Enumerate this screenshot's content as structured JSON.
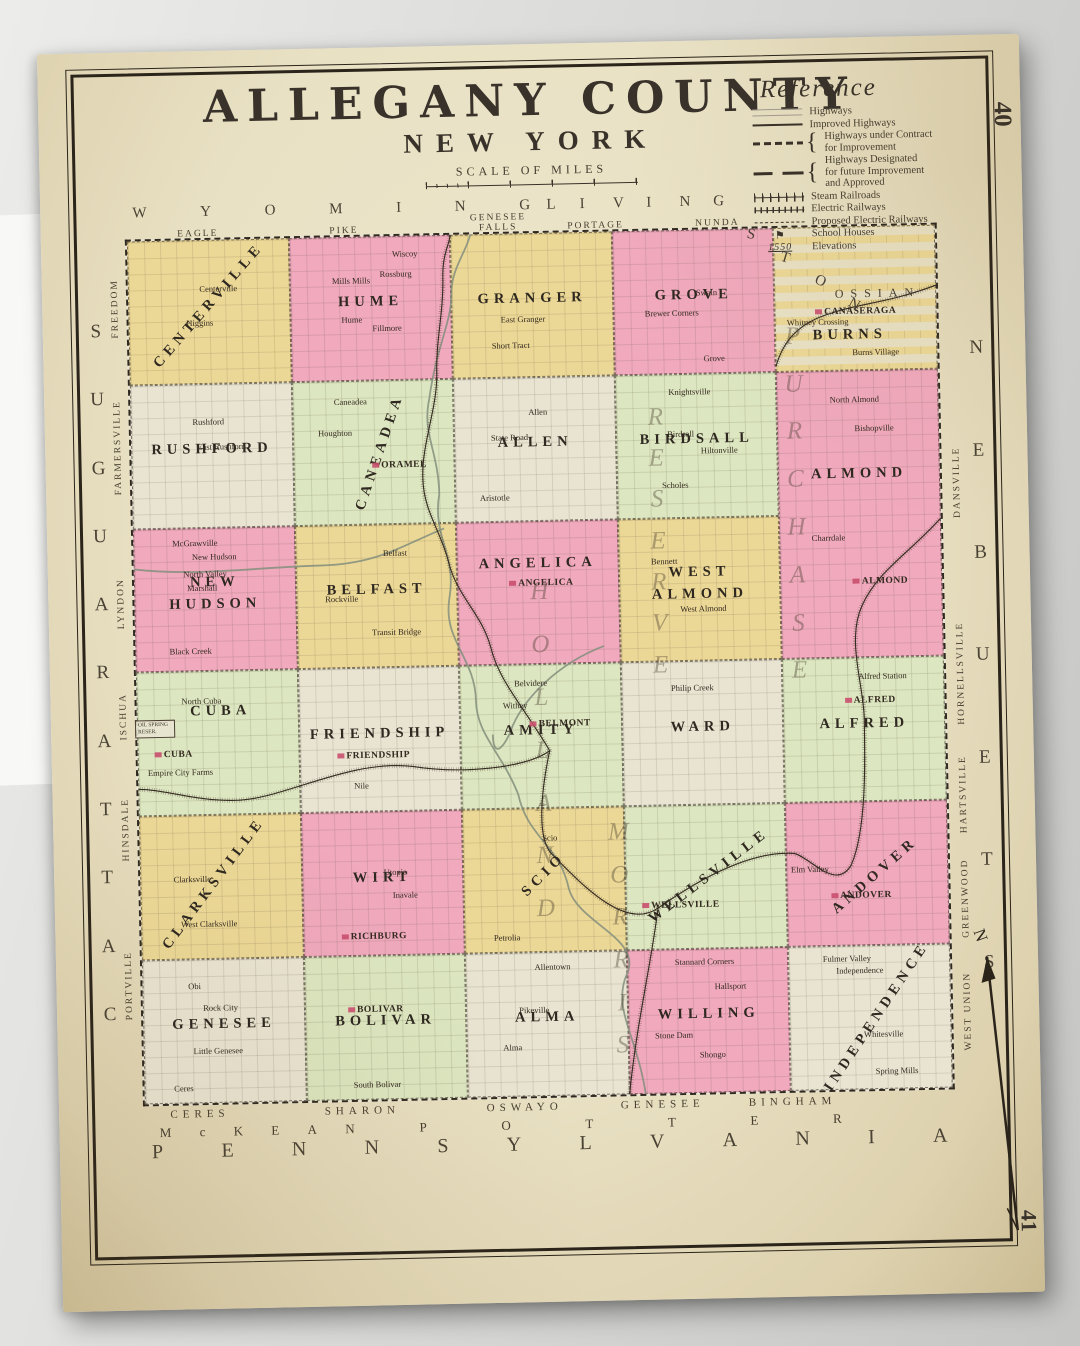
{
  "page": {
    "top_right_number": "40",
    "bottom_right_number": "41"
  },
  "title": {
    "county": "ALLEGANY COUNTY",
    "state": "NEW YORK",
    "scale_label": "SCALE OF MILES"
  },
  "compass": {
    "north_label": "N"
  },
  "colors": {
    "paper": "#e9e1c4",
    "yellow": "#ecd896",
    "pink": "#f0a9bd",
    "green": "#dce6c0",
    "cream": "#e9e4d2",
    "line": "#2f2820",
    "village_red": "#c94f6e"
  },
  "reference": {
    "title": "Reference",
    "items": [
      {
        "label": "Highways",
        "sample": "highways"
      },
      {
        "label": "Improved Highways",
        "sample": "improved"
      },
      {
        "label": "Highways under Contract\nfor Improvement",
        "sample": "contract",
        "brace": true
      },
      {
        "label": "Highways Designated\nfor future Improvement\nand Approved",
        "sample": "future",
        "brace": true
      },
      {
        "label": "Steam Railroads",
        "sample": "steam"
      },
      {
        "label": "Electric Railways",
        "sample": "electric"
      },
      {
        "label": "Proposed Electric Railways",
        "sample": "proposed"
      },
      {
        "label": "School Houses",
        "sample": "school"
      },
      {
        "label": "Elevations",
        "sample": "elevation",
        "sample_text": "1550"
      }
    ]
  },
  "neighbors": {
    "top": {
      "counties": [
        "WYOMING",
        "LIVINGSTON"
      ],
      "townships": [
        "EAGLE",
        "PIKE",
        "GENESEE FALLS",
        "PORTAGE",
        "NUNDA",
        "OSSIAN"
      ]
    },
    "left": {
      "county": "CATTARAUGUS",
      "townships": [
        "FREEDOM",
        "FARMERSVILLE",
        "LYNDON",
        "ISCHUA",
        "HINSDALE",
        "PORTVILLE"
      ]
    },
    "right": {
      "county": "STEUBEN",
      "townships": [
        "DANSVILLE",
        "HORNELLSVILLE",
        "HARTSVILLE",
        "GREENWOOD",
        "WEST UNION"
      ]
    },
    "bottom": {
      "state": "PENNSYLVANIA",
      "counties": [
        "McKEAN",
        "POTTER"
      ],
      "townships": [
        "CERES",
        "SHARON",
        "OSWAYO",
        "GENESEE",
        "BINGHAM"
      ]
    }
  },
  "land_grants": [
    {
      "name": "HOLLAND PURCHASE"
    },
    {
      "name": "MORRIS RESERVE"
    }
  ],
  "oil_spring_label": "OIL SPRING RESER.",
  "townships": [
    {
      "name": "CENTERVILLE",
      "color": "yellow",
      "col": 1,
      "row": 1,
      "angle": -48,
      "villages": [
        {
          "n": "Centerville",
          "pos": [
            56,
            34
          ]
        },
        {
          "n": "Higgins",
          "pos": [
            44,
            58
          ]
        }
      ]
    },
    {
      "name": "HUME",
      "color": "pink",
      "col": 2,
      "row": 1,
      "villages": [
        {
          "n": "Wiscoy",
          "pos": [
            72,
            12
          ]
        },
        {
          "n": "Rossburg",
          "pos": [
            66,
            26
          ]
        },
        {
          "n": "Mills Mills",
          "pos": [
            38,
            30
          ]
        },
        {
          "n": "Hume",
          "pos": [
            38,
            58
          ]
        },
        {
          "n": "Fillmore",
          "pos": [
            60,
            64
          ]
        }
      ]
    },
    {
      "name": "GRANGER",
      "color": "yellow",
      "col": 3,
      "row": 1,
      "villages": [
        {
          "n": "East Granger",
          "pos": [
            44,
            60
          ]
        },
        {
          "n": "Short Tract",
          "pos": [
            36,
            78
          ]
        }
      ]
    },
    {
      "name": "GROVE",
      "color": "pink",
      "col": 4,
      "row": 1,
      "villages": [
        {
          "n": "Swain",
          "pos": [
            58,
            44
          ]
        },
        {
          "n": "Brewer Corners",
          "pos": [
            36,
            58
          ]
        },
        {
          "n": "Grove",
          "pos": [
            62,
            90
          ]
        }
      ]
    },
    {
      "name": "BURNS",
      "color": "yellow",
      "col": 5,
      "row": 1,
      "inset_top": true,
      "name_pos": [
        46,
        76
      ],
      "villages": [
        {
          "n": "Canaseraga",
          "major": true,
          "pos": [
            50,
            60
          ]
        },
        {
          "n": "Whitney Crossing",
          "pos": [
            26,
            66
          ]
        },
        {
          "n": "Burns Village",
          "pos": [
            62,
            88
          ]
        }
      ]
    },
    {
      "name": "RUSHFORD",
      "color": "cream",
      "col": 1,
      "row": 2,
      "villages": [
        {
          "n": "Rushford",
          "pos": [
            48,
            26
          ]
        },
        {
          "n": "East Rushford",
          "pos": [
            56,
            44
          ]
        }
      ]
    },
    {
      "name": "CANEADEA",
      "color": "green",
      "col": 2,
      "row": 2,
      "angle": -70,
      "name_pos": [
        54,
        50
      ],
      "villages": [
        {
          "n": "Caneadea",
          "pos": [
            36,
            14
          ]
        },
        {
          "n": "Houghton",
          "pos": [
            26,
            36
          ]
        },
        {
          "n": "Oramel",
          "major": true,
          "pos": [
            66,
            60
          ]
        }
      ]
    },
    {
      "name": "ALLEN",
      "color": "cream",
      "col": 3,
      "row": 2,
      "villages": [
        {
          "n": "Allen",
          "pos": [
            52,
            24
          ]
        },
        {
          "n": "State Road",
          "pos": [
            34,
            42
          ]
        },
        {
          "n": "Aristotle",
          "pos": [
            24,
            84
          ]
        }
      ]
    },
    {
      "name": "BIRDSALL",
      "color": "green",
      "col": 4,
      "row": 2,
      "villages": [
        {
          "n": "Knightsville",
          "pos": [
            46,
            12
          ]
        },
        {
          "n": "Birdsall",
          "pos": [
            40,
            42
          ]
        },
        {
          "n": "Hiltonville",
          "pos": [
            64,
            54
          ]
        },
        {
          "n": "Scholes",
          "pos": [
            36,
            78
          ]
        }
      ]
    },
    {
      "name": "ALMOND",
      "color": "pink",
      "col": 5,
      "row": 2,
      "rowspan": 2,
      "name_pos": [
        50,
        36
      ],
      "villages": [
        {
          "n": "North Almond",
          "pos": [
            48,
            10
          ]
        },
        {
          "n": "Bishopville",
          "pos": [
            60,
            20
          ]
        },
        {
          "n": "Charrdale",
          "pos": [
            30,
            58
          ]
        },
        {
          "n": "Almond",
          "major": true,
          "pos": [
            62,
            74
          ]
        }
      ]
    },
    {
      "name": "NEW HUDSON",
      "color": "pink",
      "col": 1,
      "row": 3,
      "villages": [
        {
          "n": "McGrawville",
          "pos": [
            38,
            10
          ]
        },
        {
          "n": "New Hudson",
          "pos": [
            50,
            20
          ]
        },
        {
          "n": "North Valley",
          "pos": [
            44,
            32
          ]
        },
        {
          "n": "Marshall",
          "pos": [
            42,
            42
          ]
        },
        {
          "n": "Black Creek",
          "pos": [
            34,
            86
          ]
        }
      ]
    },
    {
      "name": "BELFAST",
      "color": "yellow",
      "col": 2,
      "row": 3,
      "villages": [
        {
          "n": "Belfast",
          "pos": [
            62,
            20
          ]
        },
        {
          "n": "Rockville",
          "pos": [
            28,
            52
          ]
        },
        {
          "n": "Transit Bridge",
          "pos": [
            62,
            76
          ]
        }
      ]
    },
    {
      "name": "ANGELICA",
      "color": "pink",
      "col": 3,
      "row": 3,
      "name_pos": [
        50,
        30
      ],
      "villages": [
        {
          "n": "Angelica",
          "major": true,
          "pos": [
            52,
            44
          ]
        }
      ]
    },
    {
      "name": "WEST ALMOND",
      "color": "yellow",
      "col": 4,
      "row": 3,
      "villages": [
        {
          "n": "Bennett",
          "pos": [
            28,
            30
          ]
        },
        {
          "n": "West Almond",
          "pos": [
            52,
            64
          ]
        }
      ]
    },
    {
      "name": "CUBA",
      "color": "green",
      "col": 1,
      "row": 4,
      "name_pos": [
        52,
        28
      ],
      "villages": [
        {
          "n": "North Cuba",
          "pos": [
            40,
            20
          ]
        },
        {
          "n": "Cuba",
          "major": true,
          "pos": [
            22,
            58
          ]
        },
        {
          "n": "Empire City Farms",
          "pos": [
            26,
            70
          ]
        }
      ]
    },
    {
      "name": "FRIENDSHIP",
      "color": "cream",
      "col": 2,
      "row": 4,
      "villages": [
        {
          "n": "Friendship",
          "major": true,
          "pos": [
            46,
            62
          ]
        },
        {
          "n": "Nile",
          "pos": [
            38,
            82
          ]
        }
      ]
    },
    {
      "name": "AMITY",
      "color": "green",
      "col": 3,
      "row": 4,
      "villages": [
        {
          "n": "Belvidere",
          "pos": [
            44,
            12
          ]
        },
        {
          "n": "Withey",
          "pos": [
            34,
            28
          ]
        },
        {
          "n": "Belmont",
          "major": true,
          "pos": [
            62,
            42
          ]
        }
      ]
    },
    {
      "name": "WARD",
      "color": "cream",
      "col": 4,
      "row": 4,
      "villages": [
        {
          "n": "Philip Creek",
          "pos": [
            44,
            18
          ]
        }
      ]
    },
    {
      "name": "ALFRED",
      "color": "green",
      "col": 5,
      "row": 4,
      "villages": [
        {
          "n": "Alfred Station",
          "pos": [
            62,
            12
          ]
        },
        {
          "n": "Alfred",
          "major": true,
          "pos": [
            54,
            30
          ]
        }
      ]
    },
    {
      "name": "CLARKSVILLE",
      "color": "yellow",
      "col": 1,
      "row": 5,
      "angle": -52,
      "name_pos": [
        46,
        48
      ],
      "villages": [
        {
          "n": "Clarksville",
          "pos": [
            32,
            44
          ]
        },
        {
          "n": "West Clarksville",
          "pos": [
            42,
            76
          ]
        }
      ]
    },
    {
      "name": "WIRT",
      "color": "pink",
      "col": 2,
      "row": 5,
      "villages": [
        {
          "n": "Utopia",
          "pos": [
            58,
            42
          ]
        },
        {
          "n": "Inavale",
          "pos": [
            64,
            58
          ]
        },
        {
          "n": "Richburg",
          "major": true,
          "pos": [
            44,
            88
          ]
        }
      ]
    },
    {
      "name": "SCIO",
      "color": "yellow",
      "col": 3,
      "row": 5,
      "angle": -44,
      "villages": [
        {
          "n": "Scio",
          "pos": [
            54,
            20
          ]
        },
        {
          "n": "Petrolia",
          "pos": [
            26,
            90
          ]
        }
      ]
    },
    {
      "name": "WELLSVILLE",
      "color": "green",
      "col": 4,
      "row": 5,
      "angle": -36,
      "name_pos": [
        52,
        50
      ],
      "villages": [
        {
          "n": "Wellsville",
          "major": true,
          "pos": [
            34,
            70
          ]
        }
      ]
    },
    {
      "name": "ANDOVER",
      "color": "pink",
      "col": 5,
      "row": 5,
      "angle": -40,
      "name_pos": [
        55,
        52
      ],
      "villages": [
        {
          "n": "Elm Valley",
          "pos": [
            14,
            46
          ]
        },
        {
          "n": "Andover",
          "major": true,
          "pos": [
            46,
            66
          ]
        }
      ]
    },
    {
      "name": "GENESEE",
      "color": "cream",
      "col": 1,
      "row": 6,
      "villages": [
        {
          "n": "Obi",
          "pos": [
            32,
            18
          ]
        },
        {
          "n": "Rock City",
          "pos": [
            48,
            34
          ]
        },
        {
          "n": "Little Genesee",
          "pos": [
            46,
            64
          ]
        },
        {
          "n": "Ceres",
          "pos": [
            24,
            90
          ]
        }
      ]
    },
    {
      "name": "BOLIVAR",
      "color": "green",
      "col": 2,
      "row": 6,
      "villages": [
        {
          "n": "Bolivar",
          "major": true,
          "pos": [
            44,
            38
          ]
        },
        {
          "n": "South Bolivar",
          "pos": [
            44,
            90
          ]
        }
      ]
    },
    {
      "name": "ALMA",
      "color": "cream",
      "col": 3,
      "row": 6,
      "villages": [
        {
          "n": "Allentown",
          "pos": [
            54,
            10
          ]
        },
        {
          "n": "Pikeville",
          "pos": [
            42,
            40
          ]
        },
        {
          "n": "Alma",
          "pos": [
            28,
            66
          ]
        }
      ]
    },
    {
      "name": "WILLING",
      "color": "pink",
      "col": 4,
      "row": 6,
      "villages": [
        {
          "n": "Stannard Corners",
          "pos": [
            48,
            8
          ]
        },
        {
          "n": "Hallsport",
          "pos": [
            64,
            26
          ]
        },
        {
          "n": "Stone Dam",
          "pos": [
            28,
            60
          ]
        },
        {
          "n": "Shongo",
          "pos": [
            52,
            74
          ]
        }
      ]
    },
    {
      "name": "INDEPENDENCE",
      "color": "cream",
      "col": 5,
      "row": 6,
      "angle": -55,
      "name_pos": [
        54,
        50
      ],
      "villages": [
        {
          "n": "Fulmer Valley",
          "pos": [
            36,
            8
          ]
        },
        {
          "n": "Independence",
          "pos": [
            44,
            17
          ]
        },
        {
          "n": "Whitesville",
          "pos": [
            58,
            62
          ]
        },
        {
          "n": "Spring Mills",
          "pos": [
            66,
            88
          ]
        }
      ]
    }
  ]
}
